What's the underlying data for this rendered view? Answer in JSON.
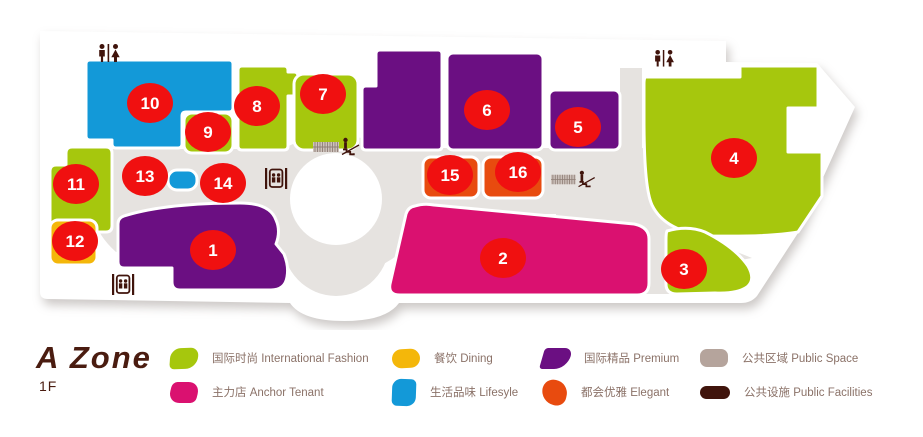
{
  "header": {
    "zone_title": "A Zone",
    "floor_label": "1F"
  },
  "map": {
    "markers": [
      {
        "label": "1"
      },
      {
        "label": "2"
      },
      {
        "label": "3"
      },
      {
        "label": "4"
      },
      {
        "label": "5"
      },
      {
        "label": "6"
      },
      {
        "label": "7"
      },
      {
        "label": "8"
      },
      {
        "label": "9"
      },
      {
        "label": "10"
      },
      {
        "label": "11"
      },
      {
        "label": "12"
      },
      {
        "label": "13"
      },
      {
        "label": "14"
      },
      {
        "label": "15"
      },
      {
        "label": "16"
      }
    ],
    "icons": [
      "restroom-icon",
      "elevator-icon",
      "escalator-icon"
    ],
    "colors": {
      "marker": "#f01010",
      "walkway": "#e6e3e0",
      "floor_plate": "#ffffff",
      "icon": "#40140c"
    }
  },
  "legend": {
    "items": [
      {
        "label": "国际时尚 International Fashion",
        "color": "#a6c70d"
      },
      {
        "label": "餐饮 Dining",
        "color": "#f4b70a"
      },
      {
        "label": "国际精品 Premium",
        "color": "#6b0f82"
      },
      {
        "label": "公共区域 Public Space",
        "color": "#b5a49c"
      },
      {
        "label": "主力店 Anchor Tenant",
        "color": "#da1170"
      },
      {
        "label": "生活品味 Lifesyle",
        "color": "#1399d8"
      },
      {
        "label": "都会优雅 Elegant",
        "color": "#e84b0f"
      },
      {
        "label": "公共设施 Public Facilities",
        "color": "#40140c"
      }
    ]
  }
}
